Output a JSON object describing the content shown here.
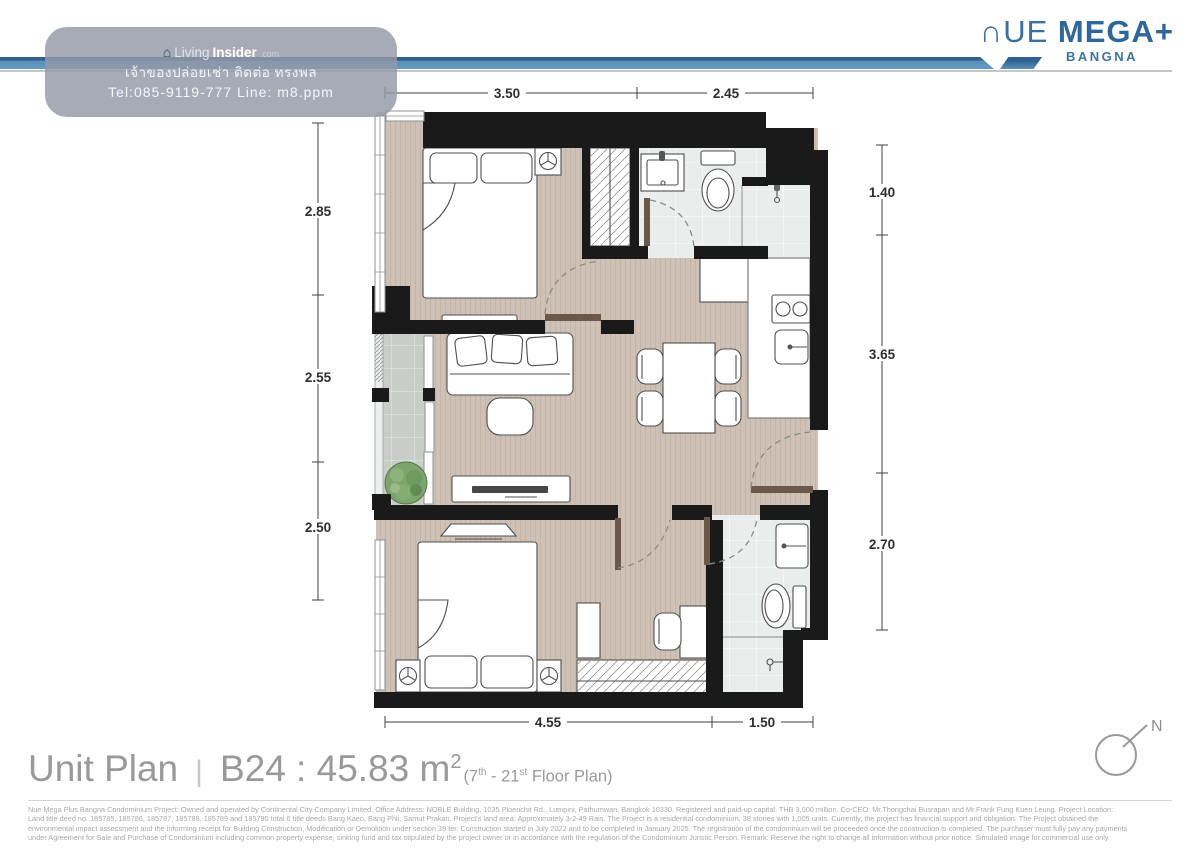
{
  "header": {
    "brand_light": "∩UE",
    "brand_bold": "MEGA+",
    "brand_subtitle": "BANGNA"
  },
  "watermark": {
    "logo_house": "⌂",
    "logo_prefix": "Living",
    "logo_bold": "Insider",
    "logo_suffix": ".com",
    "line_thai": "เจ้าของปล่อยเช่า ติดต่อ ทรงพล",
    "line_contact": "Tel:085-9119-777 Line: m8.ppm"
  },
  "plan": {
    "dimensions_top": [
      "3.50",
      "2.45"
    ],
    "dimensions_left": [
      "2.85",
      "2.55",
      "2.50"
    ],
    "dimensions_right": [
      "1.40",
      "3.65",
      "2.70"
    ],
    "dimensions_bottom": [
      "4.55",
      "1.50"
    ]
  },
  "footer": {
    "title": "Unit Plan",
    "divider": "|",
    "unit": "B24 : 45.83 m",
    "unit_sup": "2",
    "floor_prefix": "(7",
    "floor_sup1": "th",
    "floor_mid": " - 21",
    "floor_sup2": "st",
    "floor_suffix": " Floor Plan)"
  },
  "legal": {
    "lines": [
      "Nue Mega Plus Bangna Condominium Project: Owned and operated by Continental City Company Limited. Office Address: NOBLE Building, 1035 Ploenchit Rd., Lumpini, Pathumwan, Bangkok 10330. Registered and paid-up capital: THB 3,000 million. Co-CEO: Mr.Thongchai Busrapan and Mr.Frank Fung Kuen Leung. Project Location:",
      "Land title deed no. 185785, 185786, 185787, 185788, 185789 and 185790 total 6 title deeds Bang Kaeo, Bang Phli, Samut Prakan. Project's land area: Approximately 3-2-49 Rais. The Project is a residential condominium, 38 stories with 1,005 units. Currently, the project has financial support and obligation. The Project obtained the",
      "environmental impact assessment and the informing receipt for Building Construction, Modification or Demolition under section 39 ter. Construction started in July 2022 and to be completed in January 2025. The registration of the condominium will be proceeded once the construction is completed. The purchaser must fully pay any payments",
      "under Agreement for Sale and Purchase of Condominium including common property expense, sinking fund and tax stipulated by the project owner or in accordance with the regulation of the Condominium Juristic Person. Remark: Reserve the right to change all information without prior notice. Simulated image for commercial use only."
    ]
  },
  "compass": {
    "north_label": "N"
  }
}
